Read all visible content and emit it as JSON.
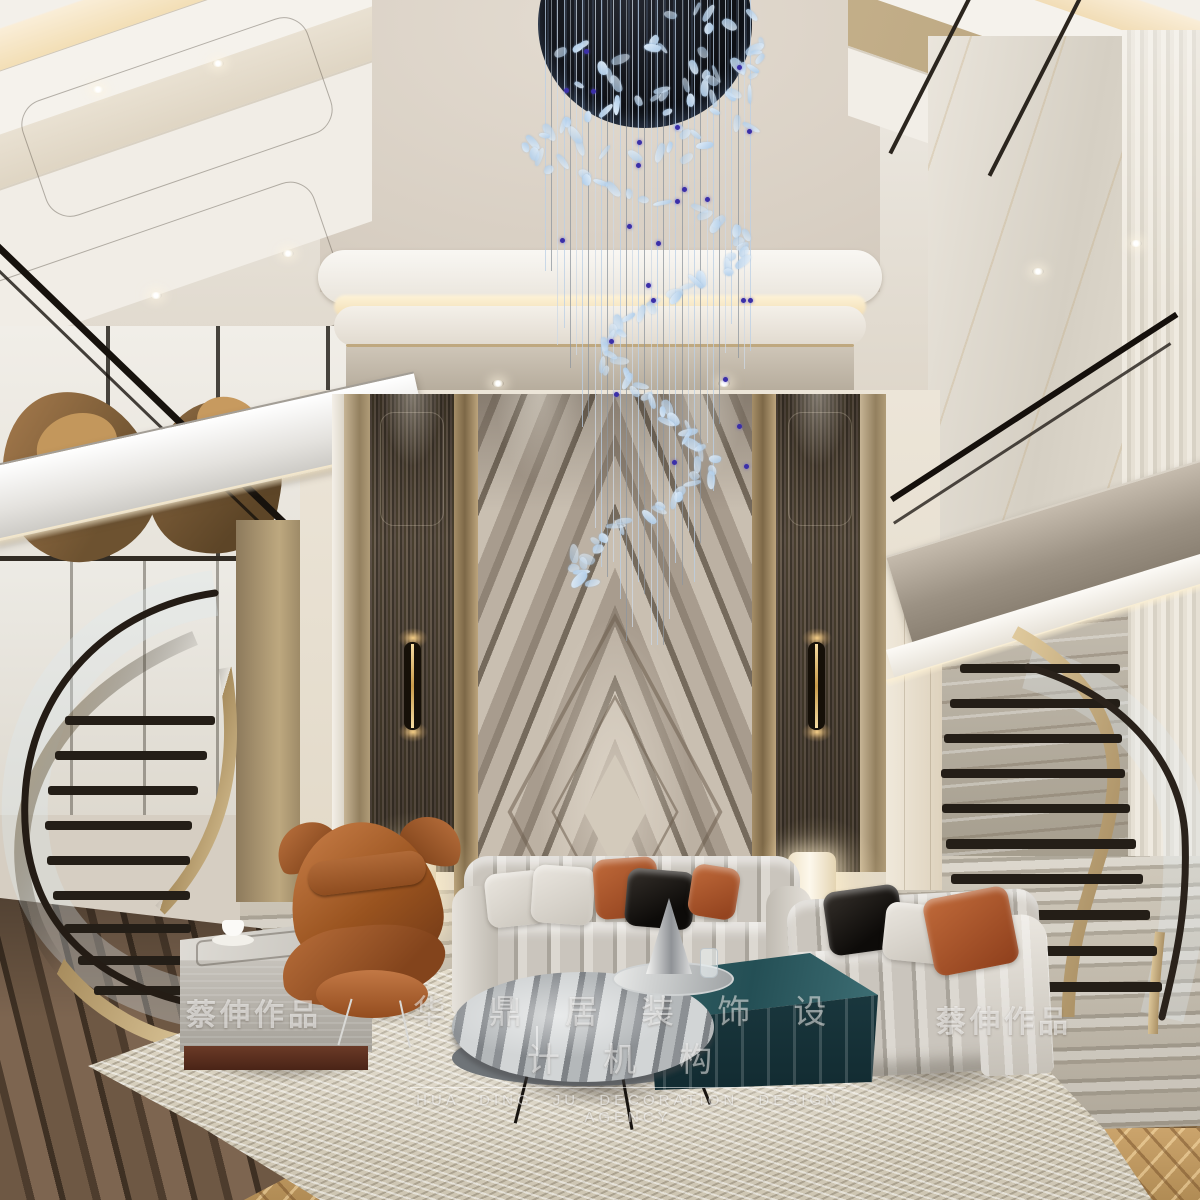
{
  "watermarks": {
    "artist_left": "蔡伸作品",
    "artist_right": "蔡伸作品",
    "agency_cn": "华 鼎 居 装 饰 设 计 机 构",
    "agency_en": "HUA DING JU DECORATION DESIGN AGENCY"
  },
  "chandelier": {
    "strand_count": 34,
    "piece_count": 150,
    "bead_count": 24,
    "disc_color": "#0b0d12",
    "glass_color": "#a9c9e8",
    "glass_light": "#e6f1fb",
    "bead_color": "#3b2fa8",
    "strand_colors": [
      "#b9cfe6",
      "#8e959e",
      "#cdd8e4"
    ]
  },
  "palette": {
    "ceiling_warm": "#d9d0c6",
    "cove_glow": "#f2ddb2",
    "wall_cream": "#e9e2d6",
    "champagne_pilaster": "#a58e68",
    "wood_panel": "#4a4138",
    "marble_feature": "#998e82",
    "sconce_black": "#161008",
    "sconce_gold": "#f6dca2",
    "sofa_fabric": "#d5d1ca",
    "pillow_orange": "#b05f33",
    "pillow_black": "#1d1a17",
    "leather_chair": "#a85c2e",
    "table_teal": "#2c5459",
    "table_marble_gray": "#9aa0a4",
    "rug": "#ddd6c5",
    "floor_wood": "#5d4a38",
    "floor_marble": "#b3ab9d",
    "stair_gold": "#c3a878",
    "railing_black": "#17120d"
  }
}
